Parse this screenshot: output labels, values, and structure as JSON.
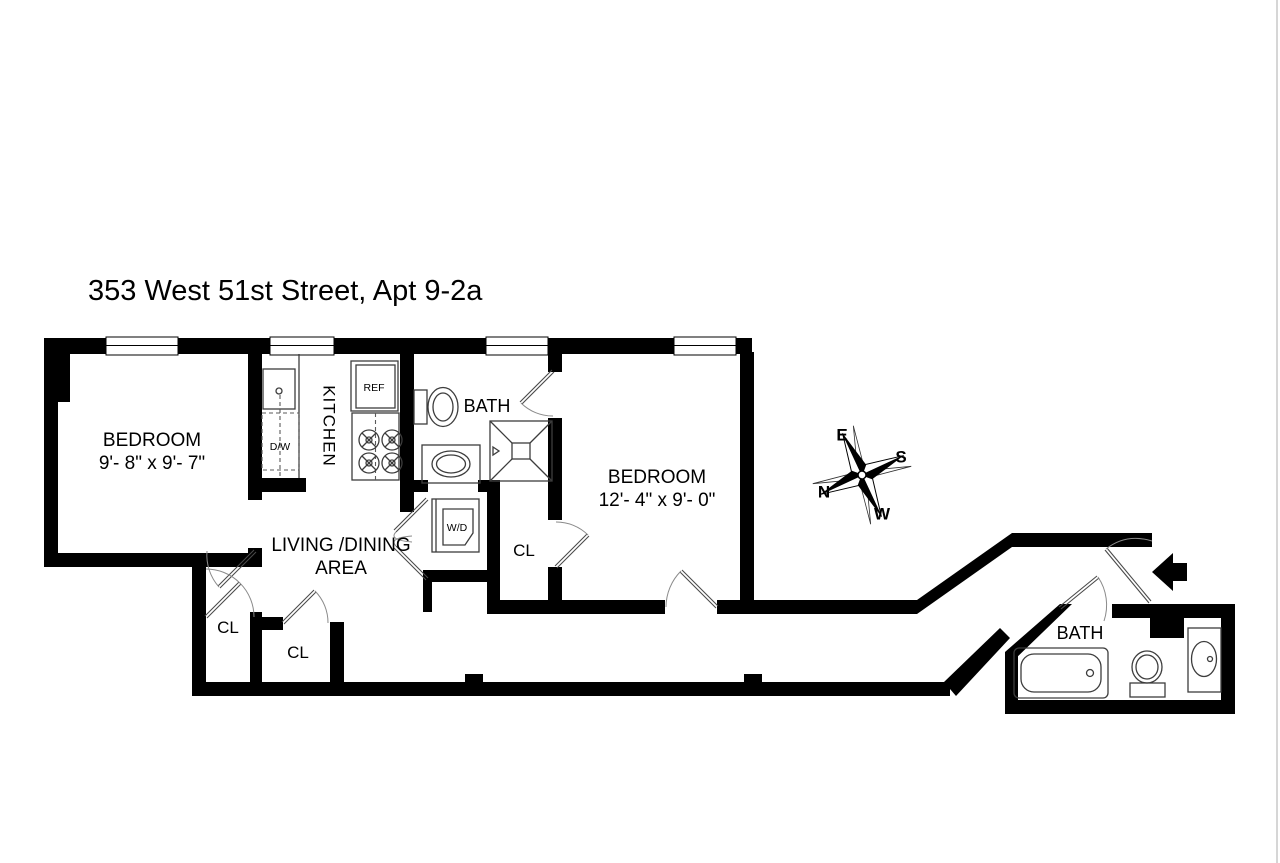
{
  "title": "353 West 51st Street,  Apt 9-2a",
  "rooms": {
    "bedroom_left": {
      "name": "BEDROOM",
      "dimensions": "9'- 8\" x 9'- 7\""
    },
    "bedroom_right": {
      "name": "BEDROOM",
      "dimensions": "12'- 4\" x 9'- 0\""
    },
    "kitchen": {
      "name": "KITCHEN"
    },
    "bath_middle": {
      "name": "BATH"
    },
    "bath_right": {
      "name": "BATH"
    },
    "living_dining": {
      "line1": "LIVING /DINING",
      "line2": "AREA"
    },
    "closet_hall_1": {
      "name": "CL"
    },
    "closet_hall_2": {
      "name": "CL"
    },
    "closet_bedroom": {
      "name": "CL"
    }
  },
  "appliances": {
    "washer_dryer": "W/D",
    "refrigerator": "REF",
    "dishwasher": "D/W"
  },
  "compass": {
    "east": "E",
    "south": "S",
    "north": "N",
    "west": "W"
  },
  "colors": {
    "walls": "#000000",
    "background": "#ffffff",
    "fixtures": "#3d3d3d",
    "doors": "#8a8a8a"
  }
}
